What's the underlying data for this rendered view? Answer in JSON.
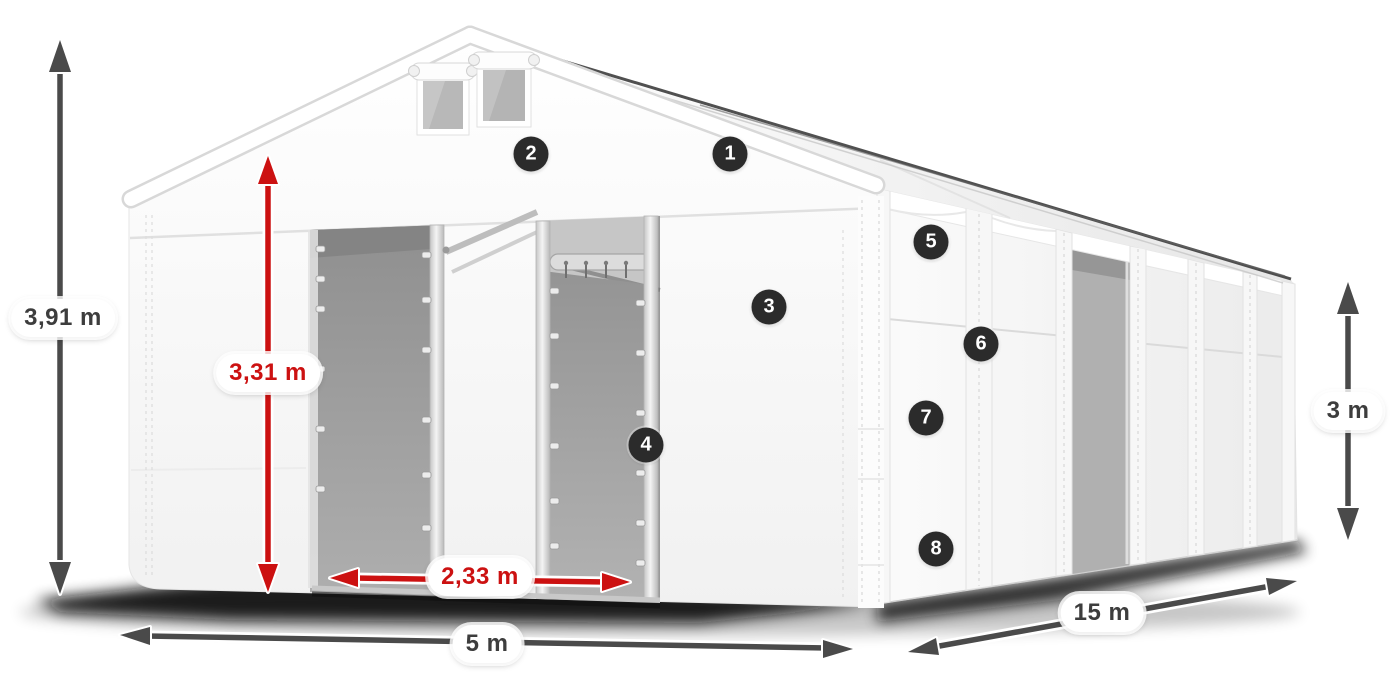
{
  "diagram": {
    "type": "tent-dimension-diagram",
    "dimensions": {
      "total_height": "3,91 m",
      "inner_height": "3,31 m",
      "entrance_width": "2,33 m",
      "width": "5 m",
      "length": "15 m",
      "side_height": "3 m"
    },
    "markers": [
      "1",
      "2",
      "3",
      "4",
      "5",
      "6",
      "7",
      "8"
    ],
    "colors": {
      "dimension_red": "#cc1111",
      "dimension_dark": "#4a4a4a",
      "label_bg": "#ffffff",
      "label_text": "#3d3d3d",
      "marker_bg": "#2b2b2b",
      "marker_text": "#ffffff"
    }
  }
}
